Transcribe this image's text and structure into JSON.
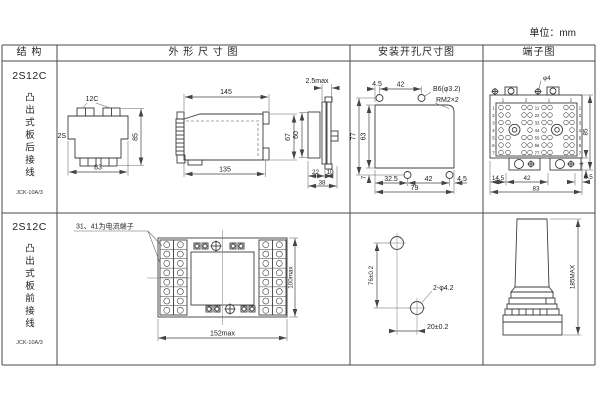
{
  "unit_label": "单位：mm",
  "headers": {
    "structure": "结 构",
    "outline": "外 形 尺 寸 图",
    "install": "安装开孔尺寸图",
    "terminal": "端子图"
  },
  "rows": [
    {
      "model": "2S12C",
      "mount": "凸出式板后接线",
      "code": "JCK-10A/3"
    },
    {
      "model": "2S12C",
      "mount": "凸出式板前接线",
      "code": "JCK-10A/3"
    }
  ],
  "rear": {
    "front": {
      "top": "12C",
      "left": "2S",
      "h": "85",
      "w": "83"
    },
    "side": {
      "top": "145",
      "bottom": "135",
      "h": "67"
    },
    "section": {
      "top": "2.5max",
      "h": "60",
      "d1": "22",
      "d2": "10",
      "d3": "38"
    },
    "install": {
      "t1": "4.5",
      "t2": "42",
      "hole": "B6(φ3.2)",
      "screw": "RM2×2",
      "h1": "77",
      "h2": "63",
      "h3": "7",
      "b1": "32.5",
      "b2": "42",
      "b3": "4.5",
      "b4": "79"
    },
    "terminal": {
      "hole": "φ4",
      "top_nums": [
        "1",
        "2",
        "1",
        "2"
      ],
      "left_nums": [
        "1",
        "2",
        "3",
        "4",
        "5",
        "6",
        "7"
      ],
      "mid_nums": [
        "11",
        "22",
        "33",
        "44",
        "55",
        "66",
        "77"
      ],
      "right_nums": [
        "1",
        "2",
        "3",
        "4",
        "5",
        "6",
        "7"
      ],
      "h": "85",
      "e": "4",
      "b1": "14.5",
      "b2": "42",
      "b3": "6.5",
      "b4": "83"
    }
  },
  "front_row": {
    "note": "31、41为电流端子",
    "board": {
      "w": "152max",
      "h": "100max"
    },
    "install": {
      "v": "76±0.2",
      "hole": "2-φ4.2",
      "h": "20±0.2"
    },
    "side": {
      "h": "185MAX"
    }
  }
}
